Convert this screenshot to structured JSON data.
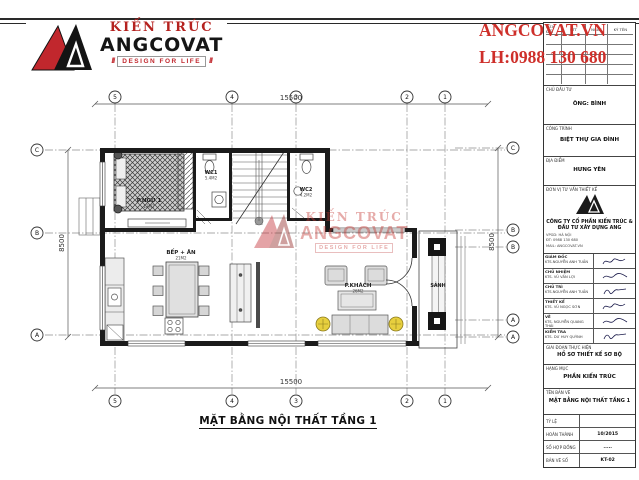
{
  "sheet": {
    "bg": "#ffffff",
    "line_color": "#2a2a2a",
    "red": "#c1272d"
  },
  "logo": {
    "brand_top": "KIẾN TRÚC",
    "brand": "ANGCOVAT",
    "tagline": "DESIGN FOR LIFE"
  },
  "contact": {
    "site": "ANGCOVAT.VN",
    "phone": "LH:0988 130 680"
  },
  "watermark": {
    "brand_top": "KIẾN TRÚC",
    "brand": "ANGCOVAT",
    "tagline": "DESIGN FOR LIFE"
  },
  "plan": {
    "title": "MẶT BẰNG NỘI THẤT TẦNG 1",
    "dims": {
      "top": "15500",
      "bottom": "15500",
      "left": "8500",
      "right": "8500"
    },
    "grid_cols": [
      "5",
      "4",
      "3",
      "2",
      "1"
    ],
    "grid_rows_left": [
      "C",
      "B",
      "A"
    ],
    "grid_rows_right": [
      "C",
      "B",
      "B",
      "A",
      "A"
    ],
    "rooms": {
      "bedroom": {
        "label": "P.NGỦ 1",
        "area": "13M2"
      },
      "wc1": {
        "label": "WC1",
        "area": "5.4M2"
      },
      "wc2": {
        "label": "WC2",
        "area": "4.2M2"
      },
      "kitchen": {
        "label": "BẾP + ĂN",
        "area": "21M2"
      },
      "living": {
        "label": "P.KHÁCH",
        "area": "26M2"
      },
      "porch": {
        "label": "SẢNH"
      }
    }
  },
  "title_block": {
    "revision": {
      "header": "SỬA ĐỔI",
      "cols": [
        "STT",
        "NGÀY",
        "KÝ TÊN"
      ],
      "empty_rows": 5
    },
    "investor": {
      "label": "CHỦ ĐẦU TƯ",
      "value": "ÔNG: BÌNH"
    },
    "project": {
      "label": "CÔNG TRÌNH",
      "value": "BIỆT THỰ GIA ĐÌNH"
    },
    "location": {
      "label": "ĐỊA ĐIỂM",
      "value": "HƯNG YÊN"
    },
    "consultant": {
      "label": "ĐƠN VỊ TƯ VẤN THIẾT KẾ",
      "company": "CÔNG TY CỔ PHẦN KIẾN TRÚC & ĐẦU TƯ XÂY DỰNG ANG",
      "contacts": [
        "VPGD: HÀ NỘI",
        "ĐT: 0988 130 680",
        "MAIL: ANGCOVAT.VN"
      ]
    },
    "signatures": [
      {
        "role": "GIÁM ĐỐC",
        "name": "KTS.NGUYỄN ANH TUẤN"
      },
      {
        "role": "CHỦ NHIỆM",
        "name": "KTS. VŨ VĂN LỢI"
      },
      {
        "role": "CHỦ TRÌ",
        "name": "KTS.NGUYỄN ANH TUẤN"
      },
      {
        "role": "THIẾT KẾ",
        "name": "KTS. VŨ NGỌC SƠN"
      },
      {
        "role": "VẼ",
        "name": "KTS. NGUYỄN QUANG THÁI"
      },
      {
        "role": "KIỂM TRA",
        "name": "KTS. DƯ HUY QUỲNH"
      }
    ],
    "stage": {
      "label": "GIAI ĐOẠN THỰC HIỆN",
      "value": "HỒ SƠ THIẾT KẾ SƠ BỘ"
    },
    "category": {
      "label": "HẠNG MỤC",
      "value": "PHẦN KIẾN TRÚC"
    },
    "drawing": {
      "label": "TÊN BẢN VẼ",
      "value": "MẶT BẰNG NỘI THẤT TẦNG 1"
    },
    "footer": [
      {
        "label": "TỶ LỆ",
        "value": ""
      },
      {
        "label": "HOÀN THÀNH",
        "value": "10/2015"
      },
      {
        "label": "SỐ HỢP ĐỒNG",
        "value": "....."
      },
      {
        "label": "BẢN VẼ SỐ",
        "value": "KT-02"
      }
    ]
  }
}
